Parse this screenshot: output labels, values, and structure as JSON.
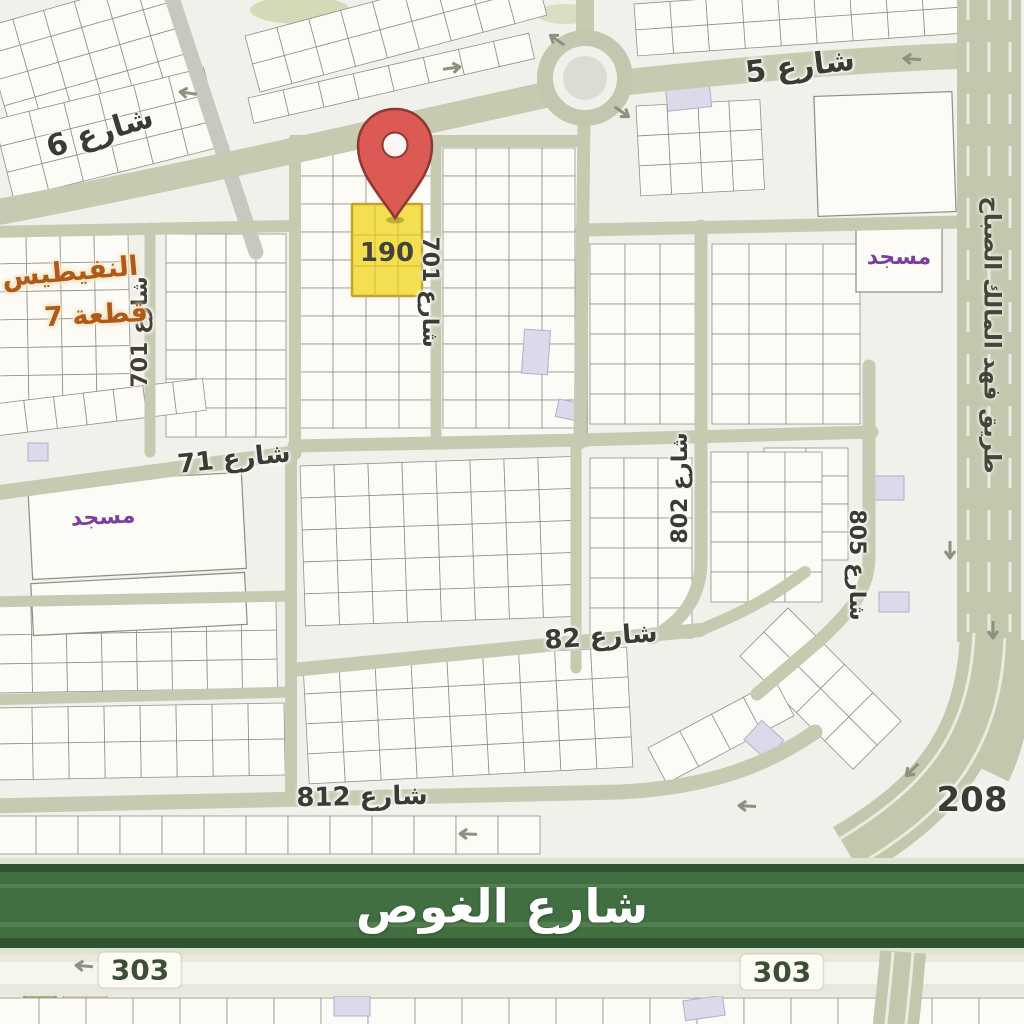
{
  "map": {
    "marker": {
      "plot_number": "190"
    },
    "area": {
      "name_line": "النفيطيس",
      "block_line": "قطعة 7"
    },
    "street_labels": {
      "s5": "شارع 5",
      "s6": "شارع 6",
      "s71": "شارع 71",
      "s82": "شارع 82",
      "s701_center": "شارع 701",
      "s701_left": "شارع 701",
      "s802": "شارع 802",
      "s805": "شارع 805",
      "s812": "شارع 812"
    },
    "major_roads": {
      "ghous": "شارع الغوص",
      "fahad": "طريق فهد المالك الصباح"
    },
    "route_numbers": {
      "r208": "208",
      "r303_left": "303",
      "r303_right": "303"
    },
    "pois": {
      "mosque_right": "مسجد",
      "mosque_left": "مسجد"
    },
    "colors": {
      "background": "#f2f0ea",
      "road_sage": "#c5cab1",
      "expressway_green": "#416f42",
      "pin_red": "#db5a54",
      "highlight_yellow": "#f3df50",
      "mosque_purple": "#7a3fa0",
      "area_orange": "#b05a1a"
    }
  }
}
